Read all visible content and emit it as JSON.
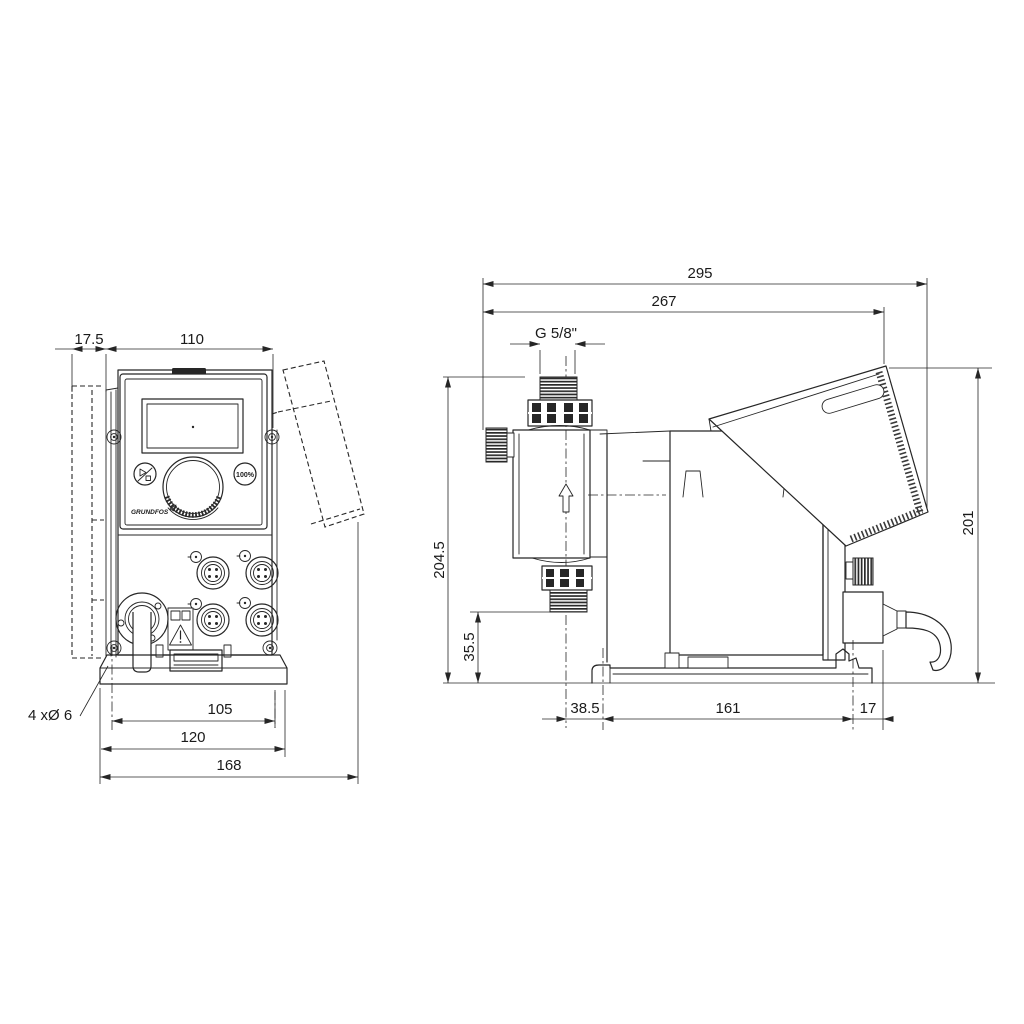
{
  "front": {
    "dim_offset": "17.5",
    "dim_width": "110",
    "dim_holes": "4 xØ 6",
    "dim_base_inner": "105",
    "dim_base": "120",
    "dim_overall": "168",
    "btn_100": "100%",
    "logo": "GRUNDFOS"
  },
  "side": {
    "dim_overall_len": "295",
    "dim_len_cover": "267",
    "dim_thread": "G 5/8\"",
    "dim_height_port": "204.5",
    "dim_port_base": "35.5",
    "dim_height": "201",
    "dim_foot_front": "38.5",
    "dim_foot_span": "161",
    "dim_rear": "17"
  },
  "colors": {
    "line": "#262626",
    "background": "#ffffff"
  }
}
